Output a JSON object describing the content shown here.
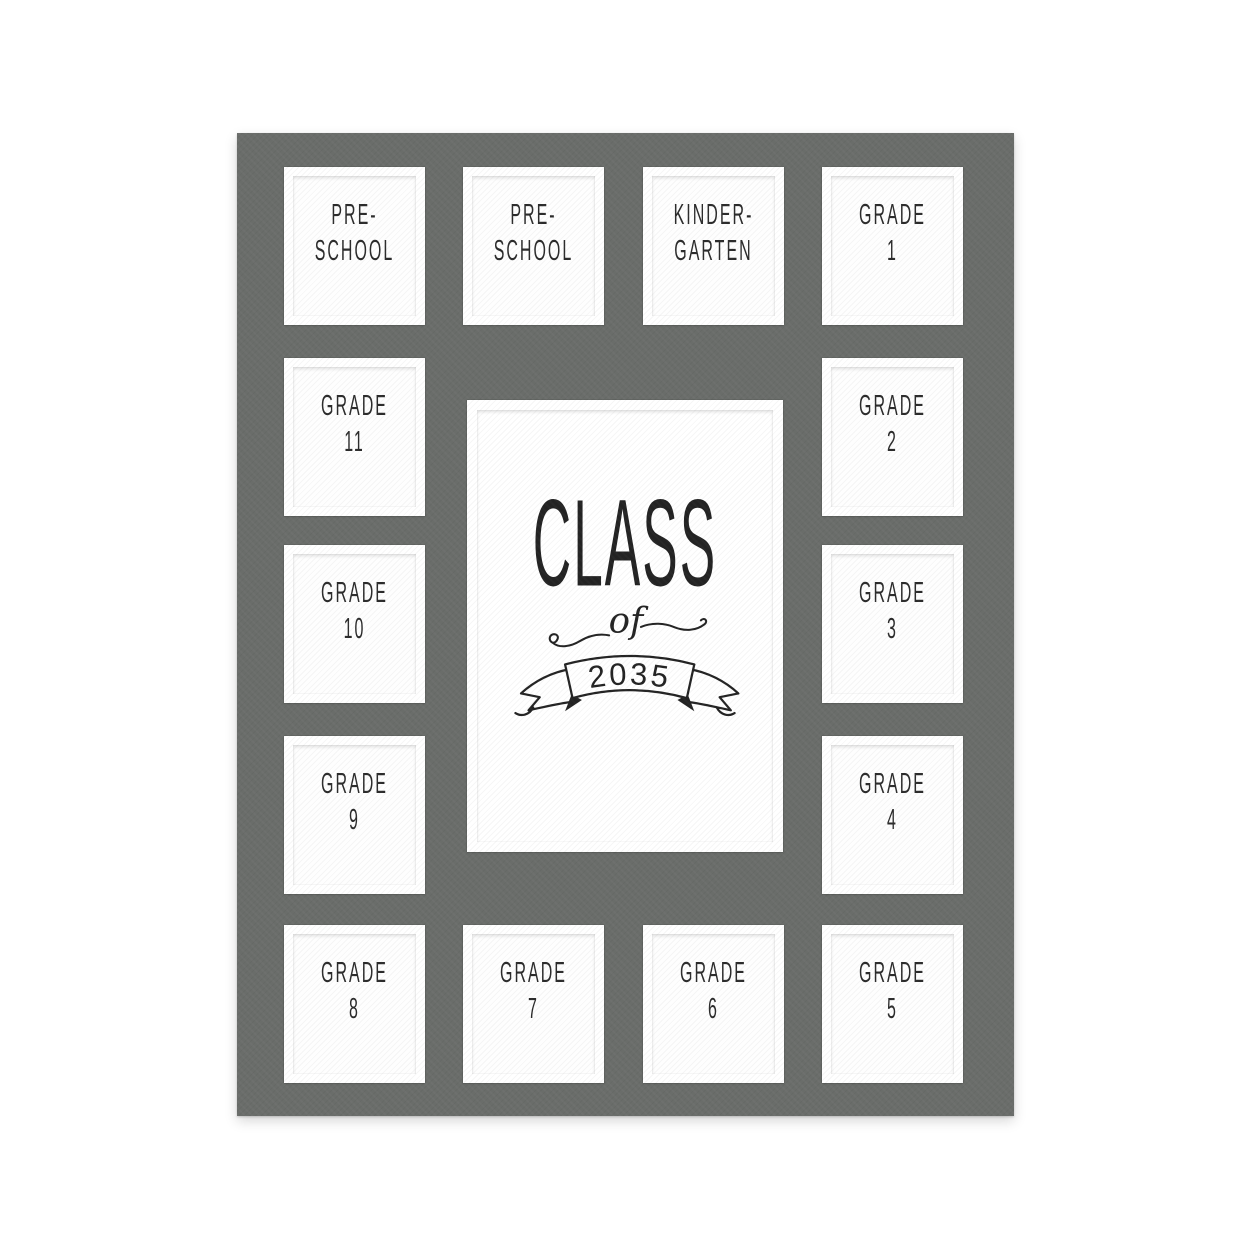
{
  "colors": {
    "mat": "#6a6d6a",
    "ink": "#2b2b2b",
    "bevel": "#ffffff",
    "background": "#ffffff"
  },
  "openings": {
    "preschool_a": {
      "line1": "PRE-",
      "line2": "SCHOOL"
    },
    "preschool_b": {
      "line1": "PRE-",
      "line2": "SCHOOL"
    },
    "kindergarten": {
      "line1": "KINDER-",
      "line2": "GARTEN"
    },
    "grade1": {
      "line1": "GRADE",
      "line2": "1"
    },
    "grade2": {
      "line1": "GRADE",
      "line2": "2"
    },
    "grade3": {
      "line1": "GRADE",
      "line2": "3"
    },
    "grade4": {
      "line1": "GRADE",
      "line2": "4"
    },
    "grade5": {
      "line1": "GRADE",
      "line2": "5"
    },
    "grade6": {
      "line1": "GRADE",
      "line2": "6"
    },
    "grade7": {
      "line1": "GRADE",
      "line2": "7"
    },
    "grade8": {
      "line1": "GRADE",
      "line2": "8"
    },
    "grade9": {
      "line1": "GRADE",
      "line2": "9"
    },
    "grade10": {
      "line1": "GRADE",
      "line2": "10"
    },
    "grade11": {
      "line1": "GRADE",
      "line2": "11"
    }
  },
  "center": {
    "word": "CLASS",
    "connector": "of",
    "year": "2035"
  }
}
